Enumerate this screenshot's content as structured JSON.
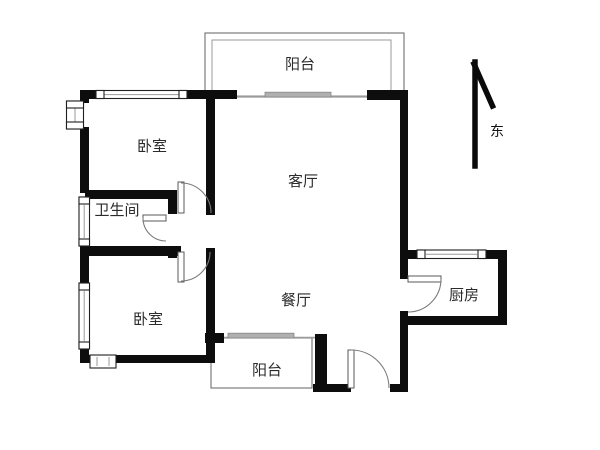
{
  "plan": {
    "type": "apartment-floor-plan",
    "background": "#ffffff",
    "colors": {
      "wall": "#0d0d0d",
      "thin_line": "#6f6f6f",
      "sliding_panel": "#b0b0b0",
      "door_arc": "#7a7a7a",
      "label_text": "#2b2b2b"
    },
    "rooms": {
      "balcony_top": {
        "label": "阳台"
      },
      "bedroom_top": {
        "label": "卧室"
      },
      "living": {
        "label": "客厅"
      },
      "bathroom": {
        "label": "卫生间"
      },
      "dining": {
        "label": "餐厅"
      },
      "bedroom_bottom": {
        "label": "卧室"
      },
      "balcony_bottom": {
        "label": "阳台"
      },
      "kitchen": {
        "label": "厨房"
      }
    },
    "compass": {
      "label": "东",
      "direction": "up"
    }
  }
}
